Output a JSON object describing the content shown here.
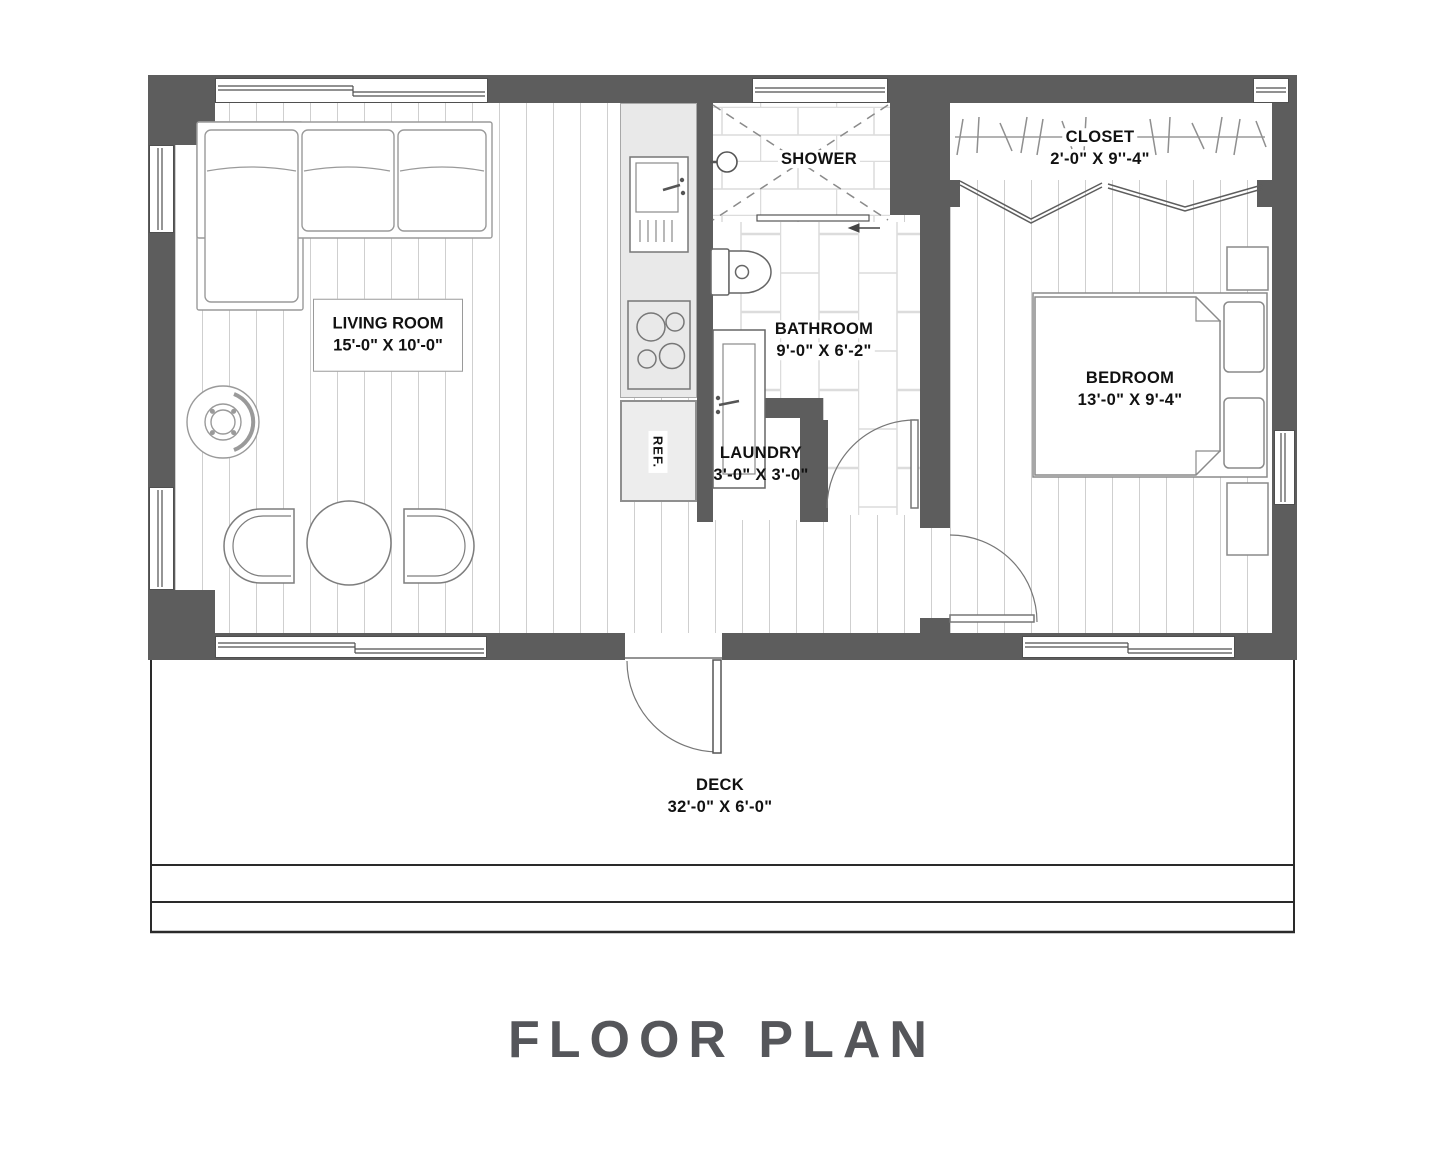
{
  "title": "FLOOR PLAN",
  "rooms": {
    "living_room": {
      "name": "LIVING ROOM",
      "dims": "15'-0\" X 10'-0\""
    },
    "shower": {
      "name": "SHOWER"
    },
    "closet": {
      "name": "CLOSET",
      "dims": "2'-0\" X 9''-4\""
    },
    "bathroom": {
      "name": "BATHROOM",
      "dims": "9'-0\" X 6'-2\""
    },
    "laundry": {
      "name": "LAUNDRY",
      "dims": "3'-0\" X 3'-0\""
    },
    "bedroom": {
      "name": "BEDROOM",
      "dims": "13'-0\" X 9'-4\""
    },
    "deck": {
      "name": "DECK",
      "dims": "32'-0\" X 6'-0\""
    }
  },
  "appliances": {
    "refrigerator_label": "REF."
  },
  "colors": {
    "wall": "#5d5d5d",
    "title_text": "#55565a",
    "counter": "#e9e9e9",
    "floor_line": "#cfcfcf",
    "tile_line": "#dcdcdc",
    "fixture_line": "#777777"
  }
}
